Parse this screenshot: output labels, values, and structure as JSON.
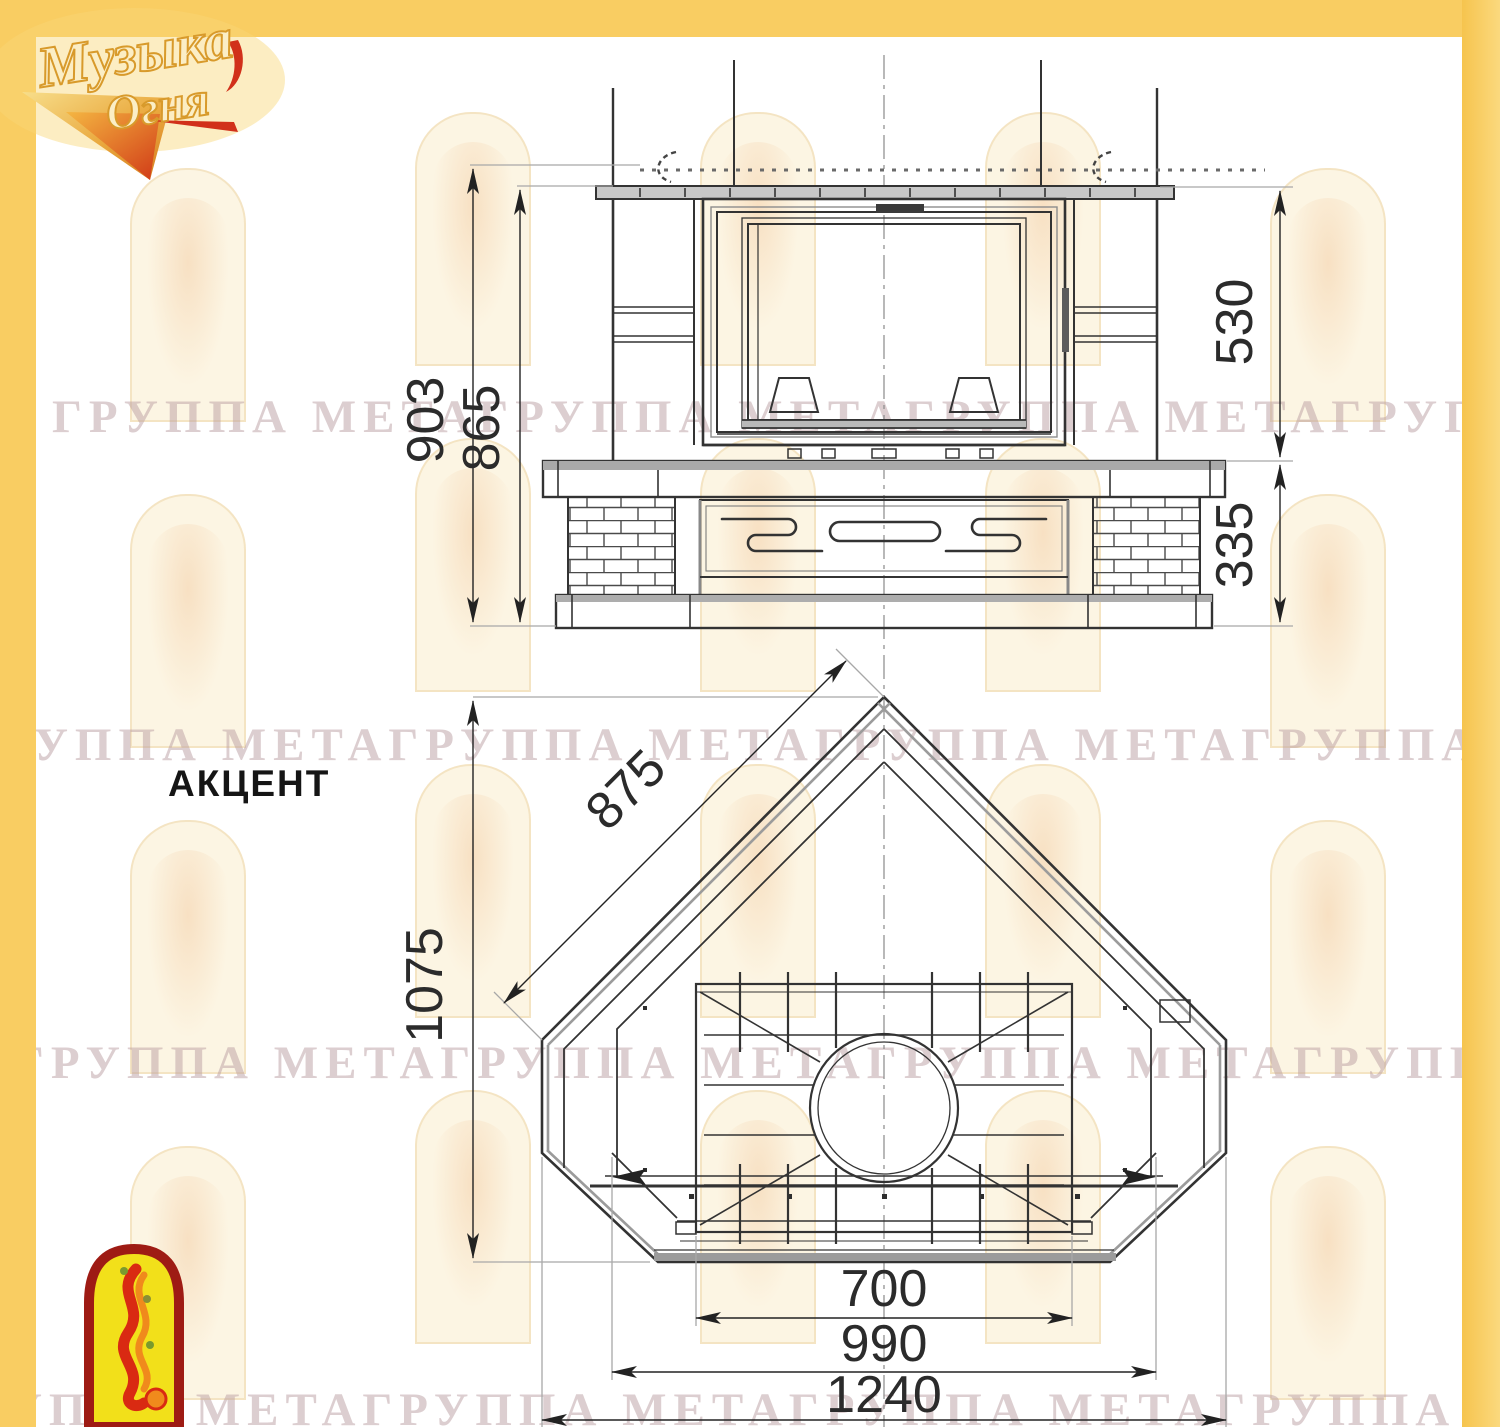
{
  "colors": {
    "frame_yellow": "#f9cd62",
    "drawing_line": "#333333",
    "dimension_text": "#2b2b2b",
    "watermark": "#b99ea2",
    "logo_gold": "#e8a63c",
    "logo_red": "#d1301a",
    "bird_panel_fill": "#f2e01a",
    "bird_panel_border": "#9e1b14"
  },
  "brand": {
    "line1": "Музыка",
    "line2": "Огня"
  },
  "model_label": "АКЦЕНТ",
  "watermark_text": "ГРУППА МЕТАГРУППА МЕТАГРУППА МЕТАГРУППА МЕТА",
  "front_view": {
    "dims": {
      "overall_height": "903",
      "body_height": "865",
      "upper_height": "530",
      "base_height": "335"
    }
  },
  "top_view": {
    "dims": {
      "side_depth": "875",
      "total_depth": "1075",
      "firebox_width": "700",
      "inner_width": "990",
      "overall_width": "1240"
    }
  }
}
